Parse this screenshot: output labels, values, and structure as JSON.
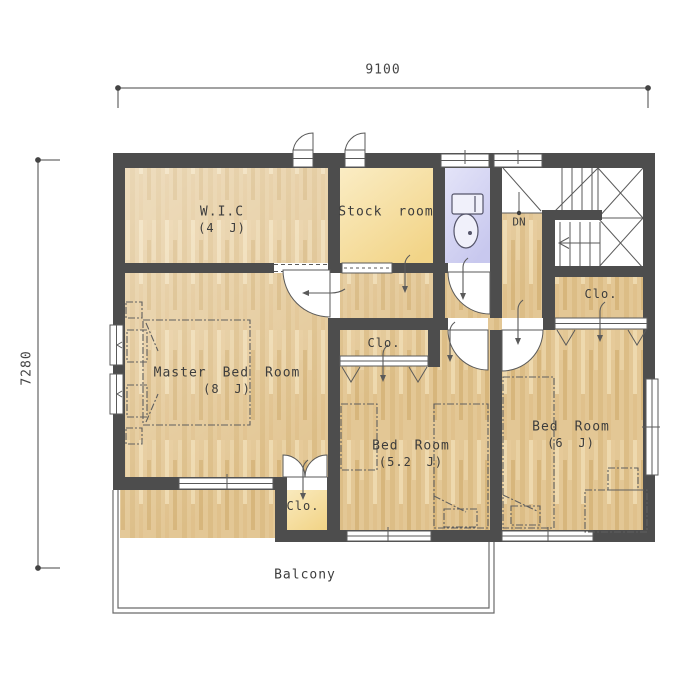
{
  "plan_title": "2F floor plan",
  "dimensions": {
    "top": "9100",
    "left": "7280"
  },
  "rooms": {
    "wic": {
      "name": "W.I.C",
      "size": "(4 J)"
    },
    "stock_room": {
      "name": "Stock room"
    },
    "toilet": {
      "name": "toilet"
    },
    "stair": {
      "direction": "DN"
    },
    "hall_closet": {
      "name": "Clo."
    },
    "master_bedroom": {
      "name": "Master Bed Room",
      "size": "(8 J)"
    },
    "mid_closet": {
      "name": "Clo."
    },
    "bedroom_52": {
      "name": "Bed Room",
      "size": "(5.2 J)"
    },
    "bedroom_6": {
      "name": "Bed Room",
      "size": "(6 J)"
    },
    "master_closet": {
      "name": "Clo."
    },
    "balcony": {
      "name": "Balcony"
    }
  },
  "colors": {
    "wall": "#4d4d4d",
    "wood_floor": "#e3c795",
    "stock_floor": "#f2d487",
    "toilet_floor": "#d9d9f2",
    "line": "#555555",
    "text": "#3d3d3d"
  }
}
